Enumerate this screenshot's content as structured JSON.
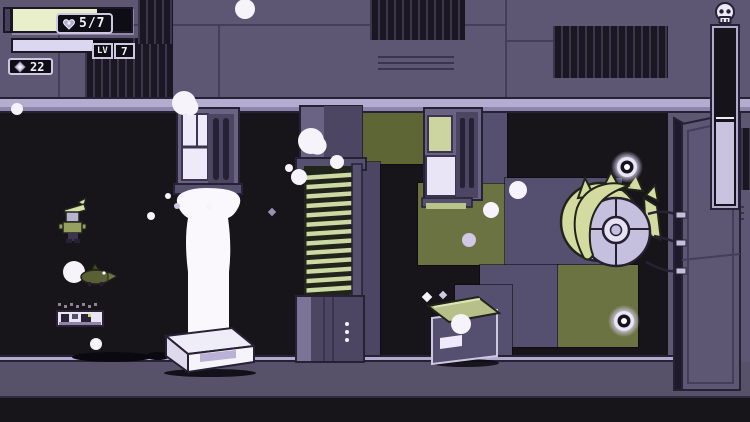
{
  "hud": {
    "health": {
      "label": "5/7",
      "current": 5,
      "max": 7,
      "fill_percent": 71,
      "icon": "heart-icon",
      "fill_color": "#e9eecb"
    },
    "level": {
      "label": "LV",
      "value": "7",
      "xp_fill_percent": 68,
      "fill_color": "#dcd7f0"
    },
    "currency": {
      "value": "22",
      "icon": "gem-icon"
    }
  },
  "scene": {
    "danger_gauge": {
      "icon": "skull-icon",
      "fill_percent": 46,
      "fill_color": "#c9c3e0"
    },
    "vent_pillar": {
      "x": 306,
      "y": 172,
      "w": 46,
      "count": 14,
      "step": 9.4,
      "fin_color": "#cdd9a3"
    },
    "orbs": [
      {
        "x": 627,
        "y": 167
      },
      {
        "x": 624,
        "y": 321
      }
    ],
    "bubbles": [
      {
        "x": 245,
        "y": 9,
        "r": 10,
        "shape": "circle",
        "tone": "white"
      },
      {
        "x": 17,
        "y": 109,
        "r": 6,
        "shape": "circle",
        "tone": "white"
      },
      {
        "x": 184,
        "y": 103,
        "r": 12,
        "shape": "blob",
        "tone": "white"
      },
      {
        "x": 311,
        "y": 141,
        "r": 13,
        "shape": "blob",
        "tone": "white"
      },
      {
        "x": 299,
        "y": 177,
        "r": 8,
        "shape": "circle",
        "tone": "white"
      },
      {
        "x": 337,
        "y": 162,
        "r": 7,
        "shape": "circle",
        "tone": "white"
      },
      {
        "x": 151,
        "y": 216,
        "r": 4,
        "shape": "circle",
        "tone": "white"
      },
      {
        "x": 289,
        "y": 168,
        "r": 4,
        "shape": "circle",
        "tone": "white"
      },
      {
        "x": 518,
        "y": 190,
        "r": 9,
        "shape": "circle",
        "tone": "white"
      },
      {
        "x": 491,
        "y": 210,
        "r": 8,
        "shape": "circle",
        "tone": "white"
      },
      {
        "x": 469,
        "y": 240,
        "r": 7,
        "shape": "circle",
        "tone": "lavender"
      },
      {
        "x": 461,
        "y": 324,
        "r": 10,
        "shape": "circle",
        "tone": "white"
      },
      {
        "x": 443,
        "y": 295,
        "r": 4,
        "shape": "diamond",
        "tone": "lavender"
      },
      {
        "x": 427,
        "y": 297,
        "r": 5,
        "shape": "diamond",
        "tone": "white"
      },
      {
        "x": 96,
        "y": 344,
        "r": 6,
        "shape": "circle",
        "tone": "white"
      },
      {
        "x": 272,
        "y": 212,
        "r": 4,
        "shape": "diamond",
        "tone": "grey"
      },
      {
        "x": 301,
        "y": 181,
        "r": 4,
        "shape": "diamond",
        "tone": "white"
      },
      {
        "x": 168,
        "y": 196,
        "r": 3,
        "shape": "circle",
        "tone": "white"
      },
      {
        "x": 177,
        "y": 206,
        "r": 3,
        "shape": "circle",
        "tone": "lavender"
      },
      {
        "x": 209,
        "y": 207,
        "r": 3,
        "shape": "circle",
        "tone": "white"
      },
      {
        "x": 347,
        "y": 324,
        "r": 2,
        "shape": "circle",
        "tone": "white"
      },
      {
        "x": 347,
        "y": 332,
        "r": 2,
        "shape": "circle",
        "tone": "white"
      },
      {
        "x": 347,
        "y": 340,
        "r": 2,
        "shape": "circle",
        "tone": "white"
      }
    ],
    "palette": {
      "wall": "#5d5773",
      "ledge": "#b5adcf",
      "block_purple": "#565070",
      "block_olive": "#6c7342",
      "background": "#17141a",
      "foam": "#faf8fc",
      "hair": "#d3dba0",
      "face": "#c5c0de",
      "floor": "#575169"
    }
  }
}
